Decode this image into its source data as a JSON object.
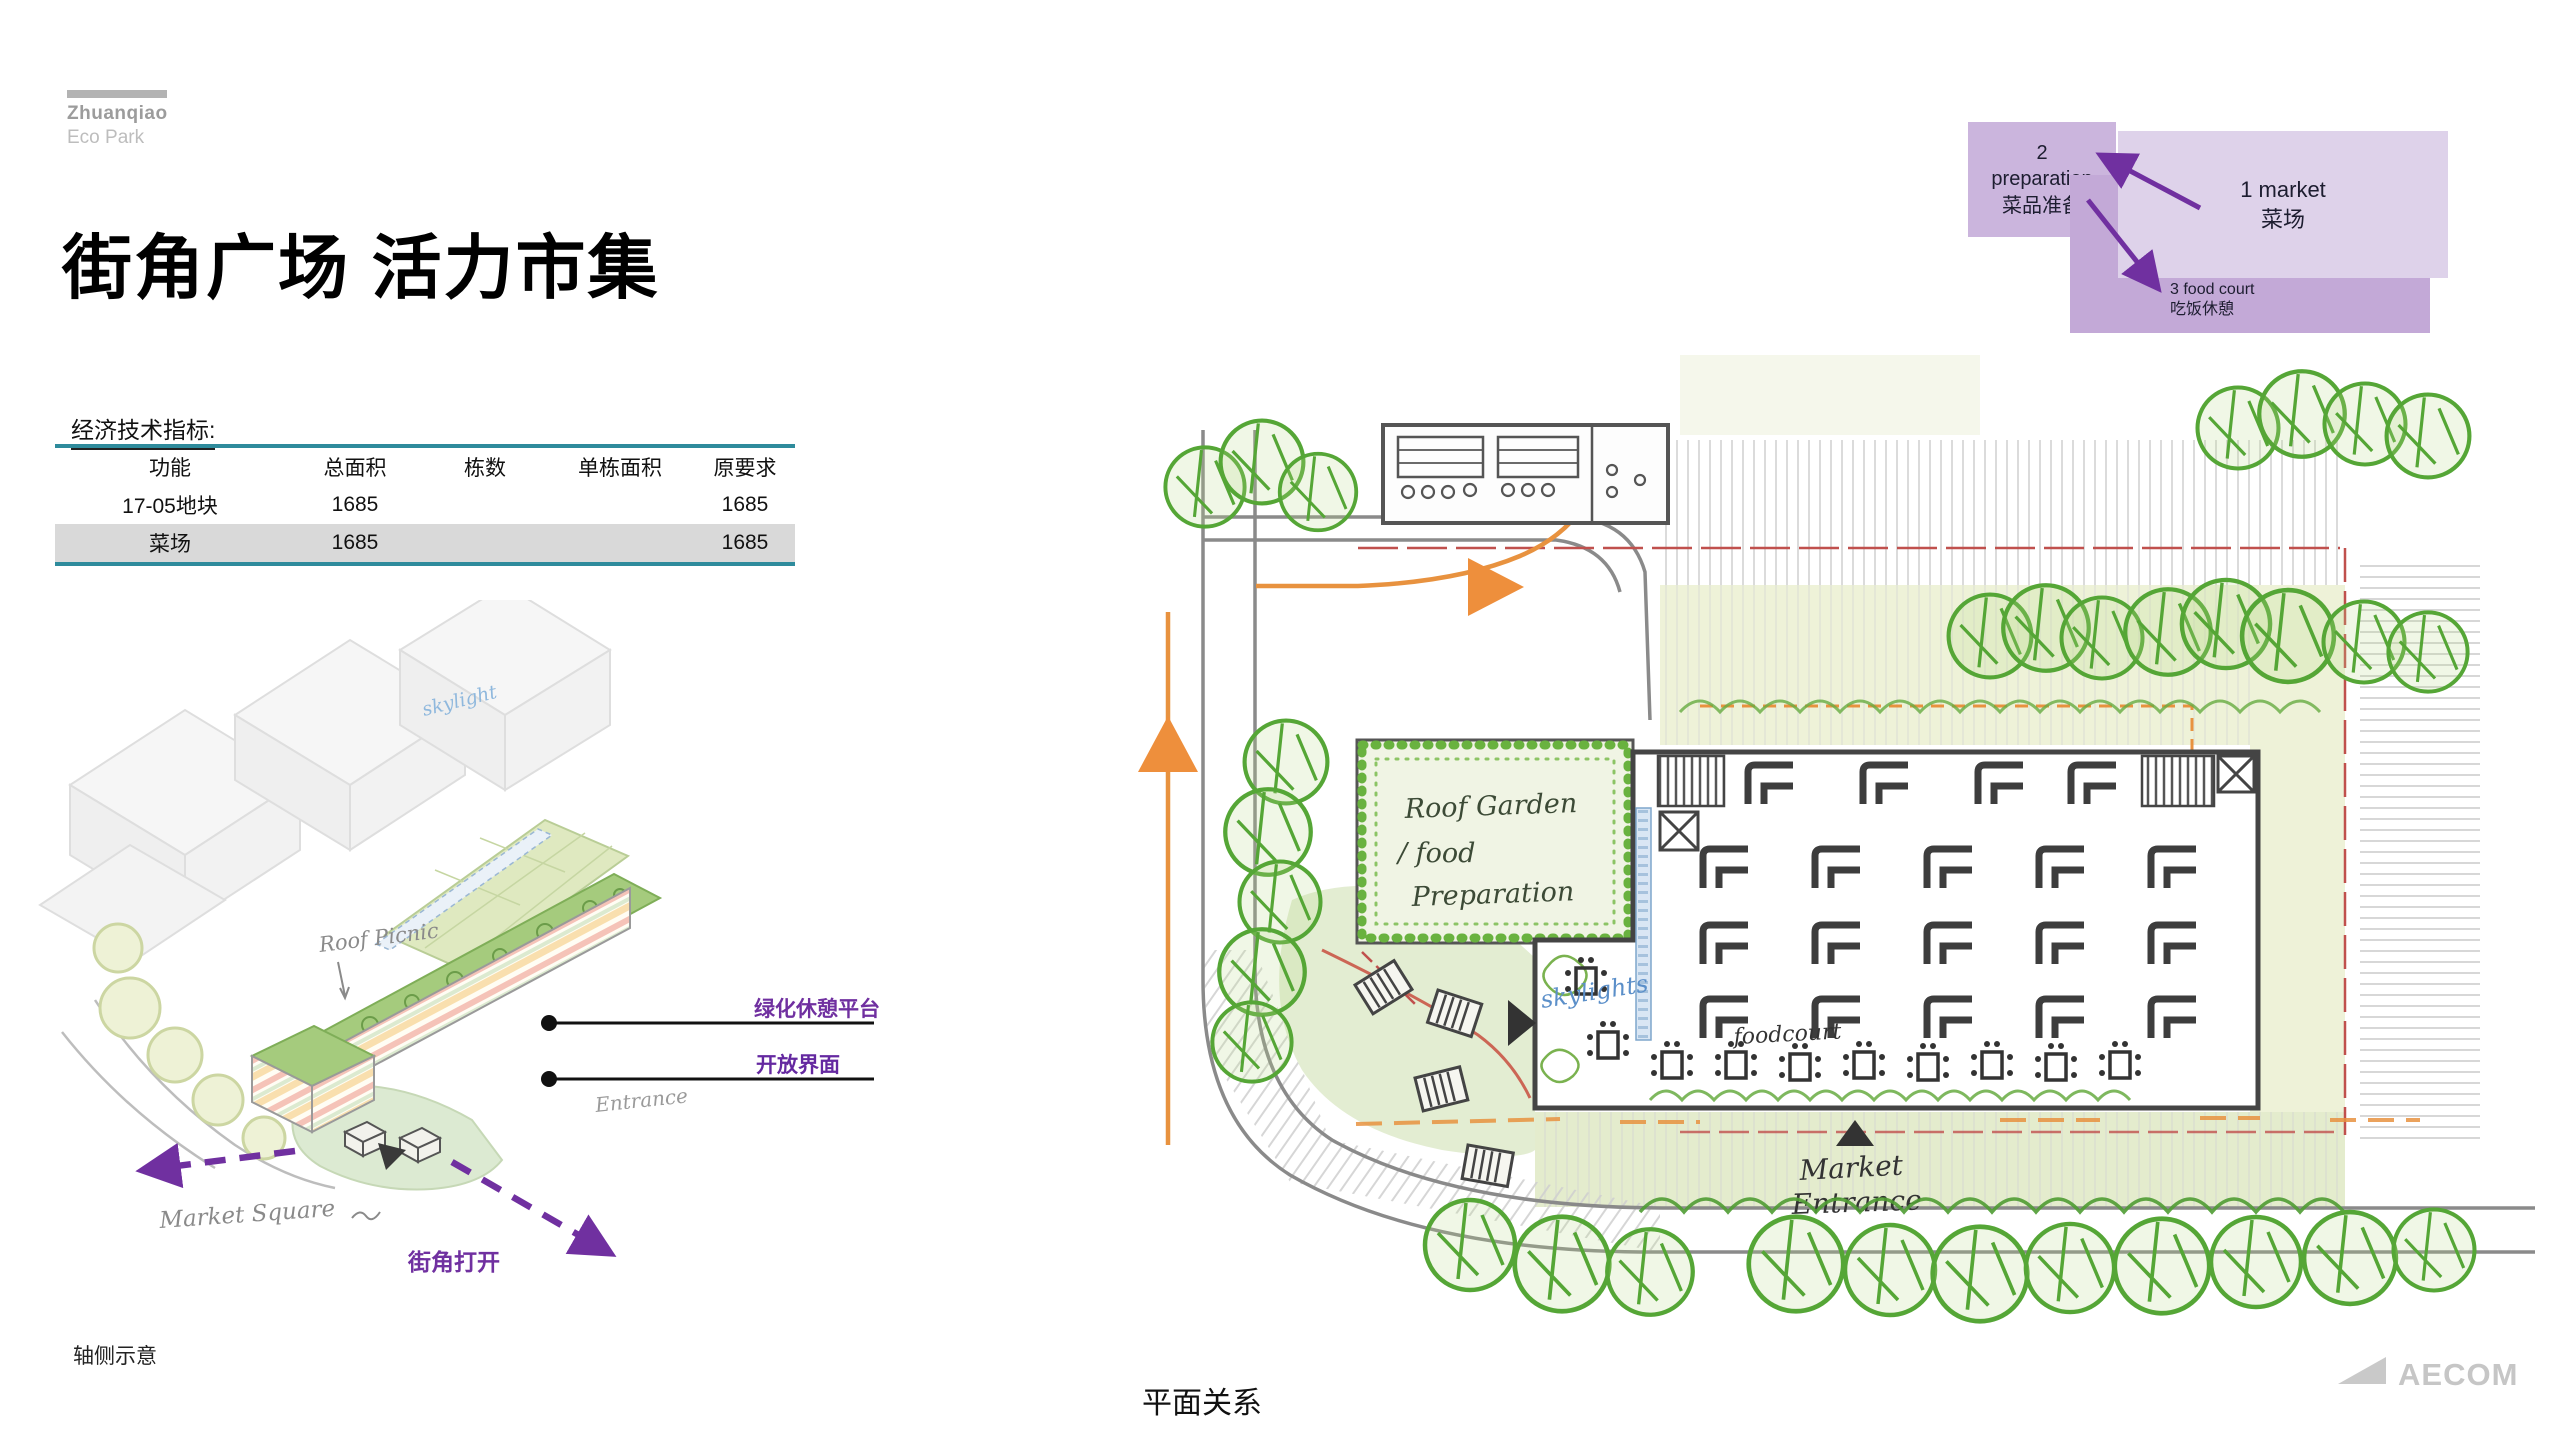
{
  "logo": {
    "name": "Zhuanqiao",
    "sub": "Eco Park"
  },
  "title": "街角广场 活力市集",
  "concept": {
    "box1": {
      "line1": "1 market",
      "line2": "菜场"
    },
    "box2": {
      "line1": "2",
      "line2": "preparation",
      "line3": "菜品准备"
    },
    "box3": {
      "line1": "3 food court",
      "line2": "吃饭休憩"
    }
  },
  "table": {
    "label": "经济技术指标:",
    "headers": [
      "功能",
      "总面积",
      "栋数",
      "单栋面积",
      "原要求"
    ],
    "rows": [
      [
        "17-05地块",
        "1685",
        "",
        "",
        "1685"
      ],
      [
        "菜场",
        "1685",
        "",
        "",
        "1685"
      ]
    ]
  },
  "axon": {
    "caption": "轴侧示意",
    "roof_picnic": "Roof Picnic",
    "skylight": "skylight",
    "entrance": "Entrance",
    "market_square": "Market Square",
    "label_platform": "绿化休憩平台",
    "label_interface": "开放界面",
    "label_corner": "街角打开"
  },
  "plan": {
    "caption": "平面关系",
    "roof_garden_1": "Roof Garden",
    "roof_garden_2": "/ food",
    "roof_garden_3": "Preparation",
    "skylights": "skylights",
    "foodcourt": "foodcourt",
    "entrance_1": "Market",
    "entrance_2": "Entrance"
  },
  "footer": {
    "brand": "AECOM"
  },
  "colors": {
    "accent_teal": "#2e8b9c",
    "table_row_gray": "#d9d9d9",
    "annotation_purple": "#7030a0",
    "concept_box_light": "#ded2ea",
    "concept_box_medium": "#cbb5dd",
    "concept_box_dark": "#c3a9d7",
    "sketch_green": "#55a636",
    "sketch_orange": "#e8923f",
    "sketch_red": "#c0504d",
    "logo_gray": "#9c9c9c"
  }
}
